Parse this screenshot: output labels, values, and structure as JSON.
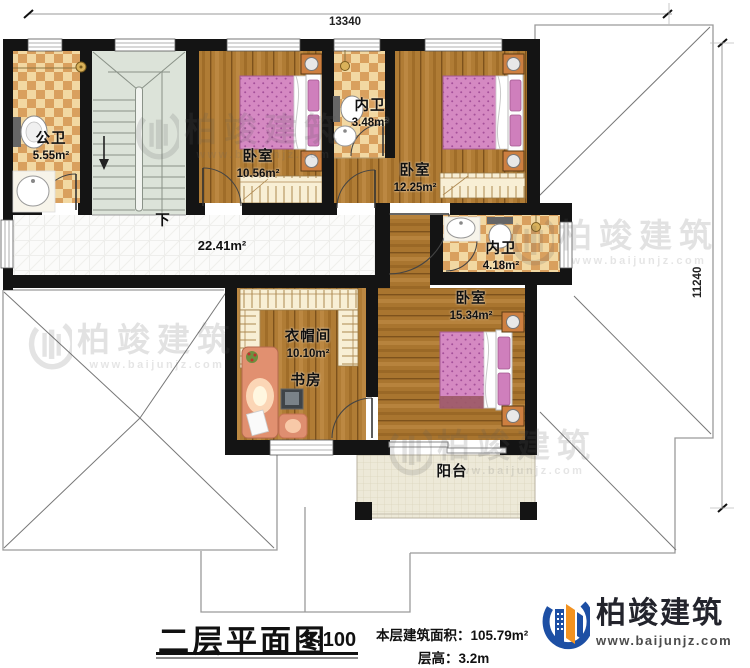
{
  "dimensions": {
    "top_width": "13340",
    "right_height": "11240"
  },
  "rooms": {
    "public_bath": {
      "name": "公卫",
      "area": "5.55m²"
    },
    "bedroom_1": {
      "name": "卧室",
      "area": "10.56m²"
    },
    "ensuite_bath_1": {
      "name": "内卫",
      "area": "3.48m²"
    },
    "bedroom_2": {
      "name": "卧室",
      "area": "12.25m²"
    },
    "ensuite_bath_2": {
      "name": "内卫",
      "area": "4.18m²"
    },
    "bedroom_3": {
      "name": "卧室",
      "area": "15.34m²"
    },
    "cloakroom": {
      "name": "衣帽间",
      "area": "10.10m²"
    },
    "study": {
      "name": "书房"
    },
    "balcony": {
      "name": "阳台"
    },
    "hall": {
      "area": "22.41m²"
    },
    "stairs": {
      "direction_label": "下"
    }
  },
  "title_block": {
    "title": "二层平面图",
    "scale": "1:100",
    "area_label": "本层建筑面积：",
    "area_value": "105.79m²",
    "height_label": "层高：",
    "height_value": "3.2m"
  },
  "brand": {
    "name": "柏竣建筑",
    "website": "www.baijunjz.com"
  },
  "watermark": {
    "text": "柏竣建筑",
    "url": "www.baijunjz.com"
  },
  "colors": {
    "wall": "#141414",
    "wood": "#b07c35",
    "tile_light": "#f2d8a2",
    "tile_dark": "#d9a05e",
    "bed_pink": "#d589c2",
    "corridor_tile": "#fbfbfa",
    "stairs": "#dce3d9",
    "balcony": "#ede9d8",
    "brand_blue": "#1d4fa4",
    "brand_orange": "#f39321"
  }
}
